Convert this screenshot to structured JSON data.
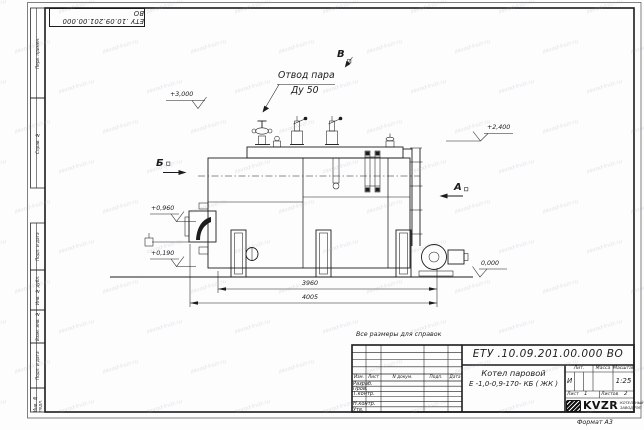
{
  "watermark": {
    "text": "zavod-kvzr.ru"
  },
  "frame": {
    "top_stamp": "ЕТУ .10.09.201.00.000  ВО",
    "side_columns": {
      "perv_primen": "Перв. примен.",
      "sprav_no": "Справ. №",
      "podp_data_1": "Подп. и дата",
      "inv_dubl": "Инв. № дубл.",
      "vzam_inv": "Взам. инв. №",
      "podp_data_2": "Подп. и дата",
      "inv_podl": "Инв. № подл."
    },
    "format_label": "Формат А3"
  },
  "drawing": {
    "note": "Все размеры для справок",
    "labels": {
      "steam_outlet_line1": "Отвод пара",
      "steam_outlet_line2": "Ду 50",
      "level_3000": "+3,000",
      "level_2400": "+2,400",
      "level_0960": "+0,960",
      "level_0190": "+0,190",
      "level_0000": "0,000",
      "view_b": "Б",
      "view_v": "В",
      "view_a": "А",
      "dim_3960": "3960",
      "dim_4005": "4005"
    }
  },
  "title_block": {
    "doc_number": "ЕТУ .10.09.201.00.000  ВО",
    "name_line1": "Котел паровой",
    "name_line2": "Е -1,0-0,9-170- КБ ( ЖК )",
    "header": {
      "izm": "Изм.",
      "list": "Лист",
      "n_dokum": "N докум.",
      "podp": "Подп.",
      "data": "Дата"
    },
    "rows": {
      "razrab": "Разраб.",
      "prov": "Пров.",
      "t_kontr": "Т.контр.",
      "n_kontr": "Н.контр.",
      "utv": "Утв."
    },
    "lit_header": "Лит.",
    "lit_value": "И",
    "massa_header": "Масса",
    "masshtab_header": "Масштаб",
    "scale": "1:25",
    "list_label": "Лист",
    "list_value": "1",
    "listov_label": "Листов",
    "listov_value": "2",
    "logo_text": "KVZR",
    "logo_sub1": "КОТЕЛЬНЫЙ",
    "logo_sub2": "ЗАВОД РЭП"
  }
}
